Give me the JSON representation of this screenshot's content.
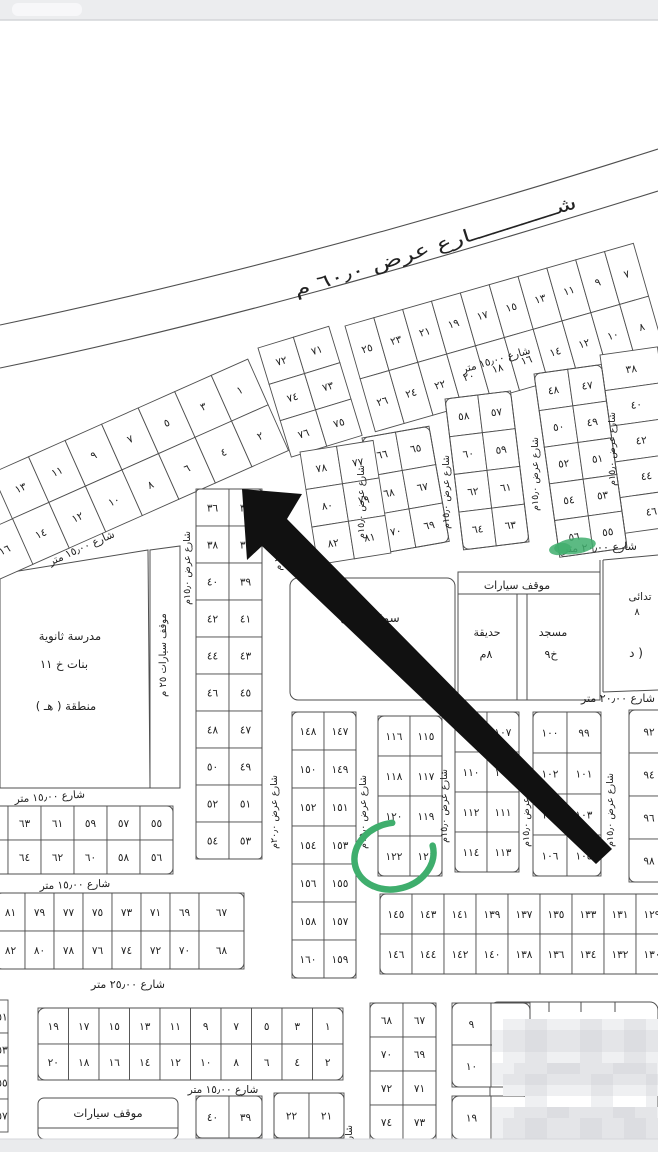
{
  "highlighted_plot": "١٢٢",
  "colors": {
    "line": "#4f4f4f",
    "text": "#222222",
    "arrow": "#111111",
    "green": "#3fae6d",
    "topbar": "#ecedef",
    "topbar_edge": "#d4d5d9",
    "footer": "#eaebed",
    "footer_edge": "#d6d7db",
    "mosaic1": "#eff0f2",
    "mosaic2": "#e4e5e8",
    "mosaic3": "#dcdde1"
  },
  "map": {
    "width": 658,
    "height": 1152,
    "topbar": {
      "h": 20
    },
    "footer": {
      "y": 1139,
      "h": 13
    },
    "roads": {
      "curves": [
        {
          "d": "M0,325 C200,283 420,225 658,149"
        },
        {
          "d": "M0,368 C210,325 430,262 658,191"
        }
      ],
      "main_label": {
        "str": "شــــــــــــارع عرض ٦٠٫٠ م",
        "x": 437,
        "y": 252,
        "rot": -17.5,
        "fs": 18,
        "len": 295
      }
    },
    "blocks": [
      {
        "name": "upper-left-1-14",
        "x": -8,
        "y": 473,
        "rot": -24,
        "cw": 40,
        "ch": 50,
        "rows": [
          [
            "١٣",
            "١١",
            "٩",
            "٧",
            "٥",
            "٣",
            "١"
          ],
          [
            "١٤",
            "١٢",
            "١٠",
            "٨",
            "٦",
            "٤",
            "٢"
          ]
        ]
      },
      {
        "name": "upper-left-16",
        "x": -24,
        "y": 535,
        "rot": -24,
        "cw": 40,
        "ch": 50,
        "rows": [
          [
            "١٦"
          ]
        ]
      },
      {
        "name": "upper-7-26",
        "x": 345,
        "y": 326,
        "rot": -16,
        "cw": 30,
        "ch": 55,
        "rows": [
          [
            "٢٥",
            "٢٣",
            "٢١",
            "١٩",
            "١٧",
            "١٥",
            "١٣",
            "١١",
            "٩",
            "٧"
          ],
          [
            "٢٦",
            "٢٤",
            "٢٢",
            "٢٠",
            "١٨",
            "١٦",
            "١٤",
            "١٢",
            "١٠",
            "٨"
          ]
        ]
      },
      {
        "name": "col-38-46",
        "x": 600,
        "y": 355,
        "rot": -8,
        "cw": 58,
        "ch": 36,
        "rows": [
          [
            "٣٨"
          ],
          [
            "٤٠"
          ],
          [
            "٤٢"
          ],
          [
            "٤٤"
          ],
          [
            "٤٦"
          ]
        ]
      },
      {
        "name": "blk-47-56",
        "x": 534,
        "y": 374,
        "rot": -8,
        "cw": 34,
        "ch": 37,
        "r": 6,
        "rows": [
          [
            "٤٨",
            "٤٧"
          ],
          [
            "٥٠",
            "٤٩"
          ],
          [
            "٥٢",
            "٥١"
          ],
          [
            "٥٤",
            "٥٣"
          ],
          [
            "٥٦",
            "٥٥"
          ]
        ]
      },
      {
        "name": "blk-57-64",
        "x": 445,
        "y": 399,
        "rot": -7,
        "cw": 33,
        "ch": 38,
        "r": 6,
        "rows": [
          [
            "٥٨",
            "٥٧"
          ],
          [
            "٦٠",
            "٥٩"
          ],
          [
            "٦٢",
            "٦١"
          ],
          [
            "٦٤",
            "٦٣"
          ]
        ]
      },
      {
        "name": "blk-65-70",
        "x": 362,
        "y": 438,
        "rot": -10,
        "cw": 34,
        "ch": 39,
        "r": 6,
        "rows": [
          [
            "٦٦",
            "٦٥"
          ],
          [
            "٦٨",
            "٦٧"
          ],
          [
            "٧٠",
            "٦٩"
          ]
        ]
      },
      {
        "name": "blk-71-76",
        "x": 258,
        "y": 348,
        "rot": -17,
        "cw": 37,
        "ch": 38,
        "rows": [
          [
            "٧٢",
            "٧١"
          ],
          [
            "٧٤",
            "٧٣"
          ],
          [
            "٧٦",
            "٧٥"
          ]
        ]
      },
      {
        "name": "blk-77-82",
        "x": 300,
        "y": 452,
        "rot": -9,
        "cw": 37,
        "ch": 38,
        "rows": [
          [
            "٧٨",
            "٧٧"
          ],
          [
            "٨٠",
            "٧٩"
          ],
          [
            "٨٢",
            "٨١"
          ]
        ]
      },
      {
        "name": "blk-35-54",
        "x": 196,
        "y": 489,
        "rot": 0,
        "cw": 33,
        "ch": 37,
        "r": 4,
        "rows": [
          [
            "٣٦",
            "٣٥"
          ],
          [
            "٣٨",
            "٣٧"
          ],
          [
            "٤٠",
            "٣٩"
          ],
          [
            "٤٢",
            "٤١"
          ],
          [
            "٤٤",
            "٤٣"
          ],
          [
            "٤٦",
            "٤٥"
          ],
          [
            "٤٨",
            "٤٧"
          ],
          [
            "٥٠",
            "٤٩"
          ],
          [
            "٥٢",
            "٥١"
          ],
          [
            "٥٤",
            "٥٣"
          ]
        ]
      },
      {
        "name": "blk-55-66",
        "x": -25,
        "y": 806,
        "cw": 33,
        "ch": 34,
        "r": 6,
        "rows": [
          [
            "٦٥",
            "٦٣",
            "٦١",
            "٥٩",
            "٥٧",
            "٥٥"
          ],
          [
            "٦٦",
            "٦٤",
            "٦٢",
            "٦٠",
            "٥٨",
            "٥٦"
          ]
        ]
      },
      {
        "name": "blk-67-82-low",
        "x": -4,
        "y": 893,
        "cw": 29,
        "ch": 38,
        "r": 6,
        "wides": {
          "7": 45
        },
        "rows": [
          [
            "٨١",
            "٧٩",
            "٧٧",
            "٧٥",
            "٧٣",
            "٧١",
            "٦٩",
            "٦٧"
          ],
          [
            "٨٢",
            "٨٠",
            "٧٨",
            "٧٦",
            "٧٤",
            "٧٢",
            "٧٠",
            "٦٨"
          ]
        ]
      },
      {
        "name": "blk-147-160",
        "x": 292,
        "y": 712,
        "cw": 32,
        "ch": 38,
        "r": 6,
        "rows": [
          [
            "١٤٨",
            "١٤٧"
          ],
          [
            "١٥٠",
            "١٤٩"
          ],
          [
            "١٥٢",
            "١٥١"
          ],
          [
            "١٥٤",
            "١٥٣"
          ],
          [
            "١٥٦",
            "١٥٥"
          ],
          [
            "١٥٨",
            "١٥٧"
          ],
          [
            "١٦٠",
            "١٥٩"
          ]
        ]
      },
      {
        "name": "blk-115-122",
        "x": 378,
        "y": 716,
        "cw": 32,
        "ch": 40,
        "r": 6,
        "rows": [
          [
            "١١٦",
            "١١٥"
          ],
          [
            "١١٨",
            "١١٧"
          ],
          [
            "١٢٠",
            "١١٩"
          ],
          [
            "١٢٢",
            "١٢١"
          ]
        ]
      },
      {
        "name": "blk-107-114",
        "x": 455,
        "y": 712,
        "cw": 32,
        "ch": 40,
        "r": 6,
        "rows": [
          [
            "١٠٨",
            "١٠٧"
          ],
          [
            "١١٠",
            "١٠٩"
          ],
          [
            "١١٢",
            "١١١"
          ],
          [
            "١١٤",
            "١١٣"
          ]
        ]
      },
      {
        "name": "blk-99-106",
        "x": 533,
        "y": 712,
        "cw": 34,
        "ch": 41,
        "r": 6,
        "rows": [
          [
            "١٠٠",
            "٩٩"
          ],
          [
            "١٠٢",
            "١٠١"
          ],
          [
            "١٠٤",
            "١٠٣"
          ],
          [
            "١٠٦",
            "١٠٥"
          ]
        ]
      },
      {
        "name": "col-92-98",
        "x": 629,
        "y": 710,
        "cw": 40,
        "ch": 43,
        "r": 6,
        "rows": [
          [
            "٩٢"
          ],
          [
            "٩٤"
          ],
          [
            "٩٦"
          ],
          [
            "٩٨"
          ]
        ]
      },
      {
        "name": "blk-127-146",
        "x": 380,
        "y": 894,
        "cw": 32,
        "ch": 40,
        "r": 6,
        "rows": [
          [
            "١٤٥",
            "١٤٣",
            "١٤١",
            "١٣٩",
            "١٣٧",
            "١٣٥",
            "١٣٣",
            "١٣١",
            "١٢٩",
            "١٢٧"
          ],
          [
            "١٤٦",
            "١٤٤",
            "١٤٢",
            "١٤٠",
            "١٣٨",
            "١٣٦",
            "١٣٤",
            "١٣٢",
            "١٣٠",
            "١٢٨"
          ]
        ]
      },
      {
        "name": "blk-1-20",
        "x": 38,
        "y": 1008,
        "cw": 30.5,
        "ch": 36,
        "r": 7,
        "rows": [
          [
            "١٩",
            "١٧",
            "١٥",
            "١٣",
            "١١",
            "٩",
            "٧",
            "٥",
            "٣",
            "١"
          ],
          [
            "٢٠",
            "١٨",
            "١٦",
            "١٤",
            "١٢",
            "١٠",
            "٨",
            "٦",
            "٤",
            "٢"
          ]
        ]
      },
      {
        "name": "edge-51-57",
        "x": -30,
        "y": 1000,
        "cw": 38,
        "ch": 33,
        "tx": 32,
        "rows": [
          [
            "٥١"
          ],
          [
            "٥٣"
          ],
          [
            "٥٥"
          ],
          [
            "٥٧"
          ]
        ]
      },
      {
        "name": "blk-39-40",
        "x": 196,
        "y": 1096,
        "cw": 33,
        "ch": 42,
        "r": 6,
        "rows": [
          [
            "٤٠",
            "٣٩"
          ]
        ]
      },
      {
        "name": "blk-21-22",
        "x": 274,
        "y": 1093,
        "cw": 35,
        "ch": 45,
        "r": 6,
        "rows": [
          [
            "٢٢",
            "٢١"
          ]
        ]
      },
      {
        "name": "blk-67-74-btm",
        "x": 370,
        "y": 1003,
        "cw": 33,
        "ch": 34,
        "r": 6,
        "rows": [
          [
            "٦٨",
            "٦٧"
          ],
          [
            "٧٠",
            "٦٩"
          ],
          [
            "٧٢",
            "٧١"
          ],
          [
            "٧٤",
            "٧٣"
          ]
        ]
      },
      {
        "name": "blk-9-10",
        "x": 452,
        "y": 1003,
        "cw": 39,
        "ch": 42,
        "r": 7,
        "rows": [
          [
            "٩",
            null
          ],
          [
            "١٠",
            null
          ]
        ]
      },
      {
        "name": "blk-19",
        "x": 452,
        "y": 1096,
        "cw": 39,
        "ch": 43,
        "r": 7,
        "rows": [
          [
            "١٩",
            null
          ]
        ]
      }
    ],
    "shapes": [
      {
        "type": "poly",
        "pts": "0,574 148,550 150,788 0,788",
        "name": "school-plot"
      },
      {
        "type": "poly",
        "pts": "150,550 180,546 180,788 150,788",
        "name": "parking-strip"
      },
      {
        "type": "rrect",
        "x": 290,
        "y": 578,
        "w": 165,
        "h": 122,
        "r": 8,
        "name": "market-plot"
      },
      {
        "type": "rect",
        "x": 458,
        "y": 572,
        "w": 142,
        "h": 128,
        "name": "mosque-garden-plot"
      },
      {
        "type": "line",
        "x1": 458,
        "y1": 594,
        "x2": 600,
        "y2": 594
      },
      {
        "type": "line",
        "x1": 517,
        "y1": 594,
        "x2": 517,
        "y2": 700
      },
      {
        "type": "line",
        "x1": 527,
        "y1": 594,
        "x2": 527,
        "y2": 700
      },
      {
        "type": "line",
        "x1": 600,
        "y1": 560,
        "x2": 600,
        "y2": 692
      },
      {
        "type": "line",
        "x1": 603,
        "y1": 560,
        "x2": 603,
        "y2": 692
      },
      {
        "type": "line",
        "x1": 603,
        "y1": 560,
        "x2": 658,
        "y2": 555
      },
      {
        "type": "line",
        "x1": 603,
        "y1": 692,
        "x2": 658,
        "y2": 690
      },
      {
        "type": "rrect",
        "x": 38,
        "y": 1098,
        "w": 140,
        "h": 41,
        "r": 6,
        "name": "parking-lot"
      },
      {
        "type": "line",
        "x1": 38,
        "y1": 1128,
        "x2": 178,
        "y2": 1128
      },
      {
        "type": "rrect",
        "x": 490,
        "y": 1002,
        "w": 168,
        "h": 137,
        "r": 8,
        "name": "watermarked-block"
      },
      {
        "type": "line",
        "x1": 516,
        "y1": 1002,
        "x2": 516,
        "y2": 1012
      },
      {
        "type": "line",
        "x1": 549,
        "y1": 1002,
        "x2": 549,
        "y2": 1012
      },
      {
        "type": "line",
        "x1": 581,
        "y1": 1002,
        "x2": 581,
        "y2": 1012
      },
      {
        "type": "line",
        "x1": 615,
        "y1": 1002,
        "x2": 615,
        "y2": 1012
      }
    ],
    "labels": [
      {
        "str": "شارع ١٥٫٠٠ متر",
        "x": 83,
        "y": 551,
        "rot": -24,
        "fs": 10.5
      },
      {
        "str": "شارع ١٥٫٠٠ متر",
        "x": 497,
        "y": 363,
        "rot": -16,
        "fs": 10.5
      },
      {
        "str": "شارع ٢٠٫٠٠ متر",
        "x": 600,
        "y": 551,
        "rot": -2,
        "fs": 11
      },
      {
        "str": "شارع ٢٠٫٠٠ متر",
        "x": 618,
        "y": 702,
        "rot": 0,
        "fs": 11
      },
      {
        "str": "شارع ١٥٫٠٠ متر",
        "x": 50,
        "y": 800,
        "rot": -4,
        "fs": 10.5
      },
      {
        "str": "شارع ١٥٫٠٠ متر",
        "x": 75,
        "y": 888,
        "rot": -2,
        "fs": 10.5
      },
      {
        "str": "شارع ٢٥٫٠٠ متر",
        "x": 128,
        "y": 988,
        "rot": 0,
        "fs": 11
      },
      {
        "str": "شارع ١٥٫٠٠ متر",
        "x": 223,
        "y": 1093,
        "rot": 0,
        "fs": 10.5
      },
      {
        "str": "مدرسة ثانوية",
        "x": 70,
        "y": 640,
        "fs": 11.5
      },
      {
        "str": "بنات    خ ١١",
        "x": 64,
        "y": 668,
        "fs": 11.5
      },
      {
        "str": "منطقة ( هـ )",
        "x": 66,
        "y": 710,
        "fs": 11.5
      },
      {
        "str": "سوق تجارى",
        "x": 370,
        "y": 622,
        "fs": 12
      },
      {
        "str": "خ ١٠",
        "x": 390,
        "y": 652,
        "fs": 11
      },
      {
        "str": "موقف سيارات",
        "x": 517,
        "y": 589,
        "fs": 11
      },
      {
        "str": "حديقة",
        "x": 487,
        "y": 636,
        "fs": 11
      },
      {
        "str": "٨م",
        "x": 486,
        "y": 658,
        "fs": 11
      },
      {
        "str": "مسجد",
        "x": 553,
        "y": 636,
        "fs": 11
      },
      {
        "str": "خ٩",
        "x": 551,
        "y": 658,
        "fs": 11
      },
      {
        "str": "تدائى",
        "x": 640,
        "y": 600,
        "fs": 10.5
      },
      {
        "str": "٨",
        "x": 637,
        "y": 615,
        "fs": 10
      },
      {
        "str": "( د",
        "x": 636,
        "y": 657,
        "fs": 12
      },
      {
        "str": "موقف سيارات",
        "x": 108,
        "y": 1117,
        "fs": 11.5
      }
    ],
    "vlabels": [
      {
        "str": "شارع عرض ١٥٫٠م",
        "x": 190,
        "y": 568
      },
      {
        "str": "٢٠٫٠ م",
        "x": 281,
        "y": 557
      },
      {
        "str": "شارع عرض ٢٠٫٠م",
        "x": 277,
        "y": 812
      },
      {
        "str": "شارع عرض ١٥٫٠م",
        "x": 366,
        "y": 812
      },
      {
        "str": "شارع عرض ١٥٫٠م",
        "x": 447,
        "y": 806
      },
      {
        "str": "شارع عرض ١٥٫٠م",
        "x": 529,
        "y": 810
      },
      {
        "str": "شارع عرض ١٥٫٠م",
        "x": 613,
        "y": 810
      },
      {
        "str": "شارع عرض ١٥٫٠م",
        "x": 449,
        "y": 492
      },
      {
        "str": "شارع عرض ١٥٫٠م",
        "x": 538,
        "y": 474
      },
      {
        "str": "شارع عرض ١٥٫٠م",
        "x": 615,
        "y": 449
      },
      {
        "str": "شارع عرض ١٥٫٠م",
        "x": 364,
        "y": 502
      },
      {
        "str": "موقف سيارات  ٢٥ م",
        "x": 166,
        "y": 655,
        "fs": 10
      },
      {
        "str": "شارع عرض ١٥٫٠م",
        "x": 352,
        "y": 1162
      },
      {
        "str": "شارع عرض ١٥٫٠م",
        "x": 503,
        "y": 1160
      }
    ],
    "arrow": {
      "points": "242,489 302,494 287,519 612,849 596,864 262,546 247,560"
    },
    "green": {
      "circle": {
        "cx": 394,
        "cy": 856,
        "rx": 40,
        "ry": 33,
        "rot": -15,
        "dash": "78 22"
      },
      "blob": [
        {
          "cx": 575,
          "cy": 546,
          "rx": 21,
          "ry": 8,
          "rot": -8
        },
        {
          "cx": 560,
          "cy": 549,
          "rx": 11,
          "ry": 6,
          "rot": -8
        }
      ]
    },
    "watermark": {
      "x": 492,
      "y": 1008,
      "cell": 11,
      "rows": [
        "00000000000000000",
        "01122111221122110",
        "12233222332233221",
        "12233222332233221",
        "01122111221122110",
        "11222333222333211",
        "12233222233222321",
        "01122111122111210",
        "00011000011000100",
        "11222332222332211",
        "12233222332233221",
        "12233222332233221",
        "01122111221122110"
      ]
    }
  }
}
